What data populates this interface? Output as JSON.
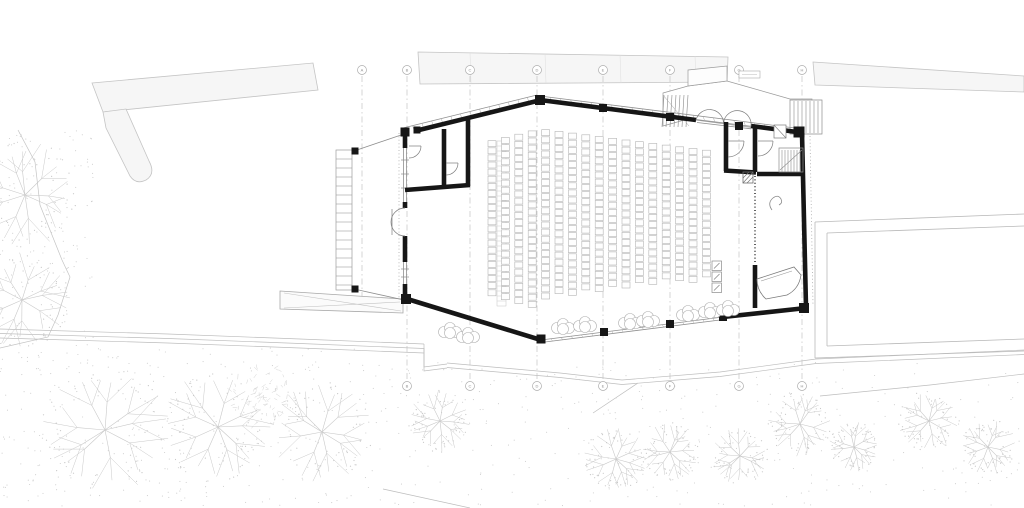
{
  "document": {
    "type": "architectural-floor-plan",
    "description": "Ground floor plan of an auditorium hall with rows of seats, entrance stairs and ramp, side rooms, grand piano room, structural grid axes and surrounding landscape (trees, paths, terrace)."
  },
  "canvas": {
    "width": 1024,
    "height": 508,
    "background": "#ffffff"
  },
  "palette": {
    "wall": "#161616",
    "line": "#6e6e6e",
    "thin": "#8f8f8f",
    "site": "#c4c4c4",
    "site_fill": "#f6f6f6",
    "grid": "#c2c2c2",
    "bubble_stroke": "#adadad",
    "bubble_text": "#8f8f8f",
    "seat": "#b5b5b5",
    "tree": "#c9c9c9",
    "scribble": "#d4d4d4",
    "stipple": "#cccccc",
    "partition": "#4f4f4f",
    "white": "#ffffff"
  },
  "grid": {
    "bubble_r": 4.5,
    "bubble_y_top": 70,
    "bubble_y_bottom": 386,
    "line_y1": 76,
    "line_y2": 380,
    "top_bubbles": [
      {
        "label": "A",
        "x": 362
      },
      {
        "label": "B",
        "x": 407
      },
      {
        "label": "C",
        "x": 470
      },
      {
        "label": "D",
        "x": 537
      },
      {
        "label": "E",
        "x": 603
      },
      {
        "label": "F",
        "x": 670
      },
      {
        "label": "G",
        "x": 739
      },
      {
        "label": "H",
        "x": 802
      }
    ],
    "bottom_bubbles": [
      {
        "label": "B",
        "x": 407
      },
      {
        "label": "C",
        "x": 470
      },
      {
        "label": "D",
        "x": 537
      },
      {
        "label": "E",
        "x": 603
      },
      {
        "label": "F",
        "x": 670
      },
      {
        "label": "G",
        "x": 739
      },
      {
        "label": "H",
        "x": 802
      }
    ],
    "short_line": {
      "x": 362,
      "y1": 76,
      "y2": 302
    }
  },
  "site": {
    "bands": [
      {
        "name": "retaining-wall-top-left",
        "points": "92,83 313,63 318,90 103,112"
      },
      {
        "name": "retaining-wall-top-center",
        "points": "418,52 728,57 727,82 420,84"
      },
      {
        "name": "retaining-wall-top-right",
        "points": "813,62 1024,76 1024,92 815,85"
      }
    ],
    "finger_path": "M103,112 L126,109 L149,161 Q156,174 146,180 Q136,185 130,176 L106,128 Z",
    "band_joints": [
      [
        470,
        53,
        471,
        83
      ],
      [
        545,
        54,
        546,
        83
      ],
      [
        620,
        55,
        621,
        83
      ],
      [
        695,
        56,
        696,
        82
      ]
    ],
    "left_slope_points": "18,130 35,162 40,205 62,260 70,277 58,315 48,337 0,348",
    "terrain_paths": [
      {
        "points": [
          [
            0,
            329
          ],
          [
            168,
            334
          ],
          [
            300,
            339
          ],
          [
            424,
            344
          ]
        ],
        "offsets": [
          0,
          4.5,
          9
        ]
      },
      {
        "points": [
          [
            424,
            344
          ],
          [
            424,
            367
          ],
          [
            447,
            364
          ]
        ],
        "offsets": [
          0,
          4
        ]
      },
      {
        "points": [
          [
            447,
            363
          ],
          [
            560,
            373
          ],
          [
            622,
            380
          ],
          [
            720,
            372
          ],
          [
            816,
            359
          ],
          [
            1024,
            350
          ]
        ],
        "offsets": [
          0,
          4.5
        ]
      },
      {
        "points": [
          [
            820,
            396
          ],
          [
            930,
            385
          ],
          [
            1024,
            374
          ]
        ],
        "offsets": [
          0
        ]
      },
      {
        "points": [
          [
            593,
            413
          ],
          [
            638,
            383
          ]
        ],
        "offsets": [
          0
        ]
      },
      {
        "points": [
          [
            383,
            489
          ],
          [
            470,
            508
          ]
        ],
        "offsets": [
          0
        ]
      }
    ],
    "terrace": {
      "outer": [
        "M815,222 L1024,214",
        "M815,222 L815,358",
        "M815,358 L1024,351"
      ],
      "inner": [
        "M827,233 L1024,226",
        "M827,233 L827,346",
        "M827,346 L1024,339"
      ]
    },
    "walkway": {
      "outline": "280,291 403,299 403,313 280,309",
      "lines": [
        "M284,293 L401,311",
        "M284,308 L400,302"
      ]
    },
    "stipple_regions": [
      {
        "x": 0,
        "y": 348,
        "w": 430,
        "h": 158,
        "count": 380,
        "seed": 11
      },
      {
        "x": 430,
        "y": 362,
        "w": 594,
        "h": 144,
        "count": 300,
        "seed": 29
      },
      {
        "x": 0,
        "y": 128,
        "w": 95,
        "h": 218,
        "count": 130,
        "seed": 47
      }
    ],
    "trees": [
      {
        "x": 25,
        "y": 195,
        "r": 52,
        "style": "branch"
      },
      {
        "x": 22,
        "y": 300,
        "r": 46,
        "style": "branch"
      },
      {
        "x": 105,
        "y": 430,
        "r": 62,
        "style": "branch"
      },
      {
        "x": 218,
        "y": 427,
        "r": 54,
        "style": "branch"
      },
      {
        "x": 262,
        "y": 396,
        "r": 33,
        "style": "scribble"
      },
      {
        "x": 322,
        "y": 432,
        "r": 48,
        "style": "branch"
      },
      {
        "x": 440,
        "y": 421,
        "r": 30,
        "style": "branch"
      },
      {
        "x": 616,
        "y": 459,
        "r": 31,
        "style": "branch"
      },
      {
        "x": 670,
        "y": 452,
        "r": 28,
        "style": "branch"
      },
      {
        "x": 740,
        "y": 456,
        "r": 27,
        "style": "branch"
      },
      {
        "x": 800,
        "y": 424,
        "r": 31,
        "style": "branch"
      },
      {
        "x": 854,
        "y": 447,
        "r": 24,
        "style": "branch"
      },
      {
        "x": 929,
        "y": 421,
        "r": 29,
        "style": "branch"
      },
      {
        "x": 988,
        "y": 447,
        "r": 27,
        "style": "branch"
      },
      {
        "x": 709,
        "y": 91,
        "r": 10,
        "style": "circle"
      }
    ],
    "shrubs": [
      {
        "x": 450,
        "y": 331
      },
      {
        "x": 468,
        "y": 336
      },
      {
        "x": 563,
        "y": 327
      },
      {
        "x": 585,
        "y": 325
      },
      {
        "x": 630,
        "y": 322
      },
      {
        "x": 648,
        "y": 320
      },
      {
        "x": 688,
        "y": 314
      },
      {
        "x": 710,
        "y": 311
      },
      {
        "x": 728,
        "y": 309
      }
    ]
  },
  "building": {
    "walls_thick": [
      "M405,131 L405,148",
      "M405,202 L405,208",
      "M405,236 L405,262",
      "M405,284 L405,300",
      "M415,131 L541,100",
      "M540,100 L696,120",
      "M751,126 L797,132",
      "M802,133 L806,307",
      "M806,308 L723,317",
      "M755,265 L755,308",
      "M404,298 L541,340",
      "M405,190 L470,185",
      "M444,129 L444,189",
      "M468,117 L468,186",
      "M726,122 L726,171",
      "M724,170.5 L756,172.5",
      "M755,128 L755,172",
      "M757,174 L803,174"
    ],
    "blocks": [
      [
        405,
        132,
        9
      ],
      [
        540,
        100,
        10
      ],
      [
        799,
        132,
        11
      ],
      [
        804,
        308,
        10
      ],
      [
        406,
        299,
        10
      ],
      [
        541,
        339,
        9
      ],
      [
        604,
        332,
        8
      ],
      [
        670,
        324,
        8
      ],
      [
        723,
        317,
        8
      ],
      [
        603,
        108,
        8
      ],
      [
        670,
        117,
        8
      ],
      [
        739,
        126,
        8
      ],
      [
        417,
        130,
        7
      ],
      [
        355,
        151,
        7
      ],
      [
        355,
        289,
        7
      ]
    ],
    "thin_paths": [
      "M403,128 L537,95",
      "M540,96 L795,128",
      "M403.5,148 L403.5,204",
      "M406.5,148 L406.5,204",
      "M403.5,262 L403.5,284",
      "M406.5,262 L406.5,284",
      "M696,119.5 L751,126.3",
      "M697,122.5 L751,128.8",
      "M541,340 L723,317",
      "M541,342.5 L724,319.5",
      "M354,151 L404,134",
      "M354,289 L404,300",
      "M392,209 L392,235"
    ],
    "dotted_paths": [
      {
        "d": "M399,133 L399,299",
        "w": 0.8
      },
      {
        "d": "M810,136 L813,306",
        "w": 0.8
      },
      {
        "d": "M755,176 L755,264",
        "w": 1.8,
        "partition": true
      }
    ],
    "window_ticks": [
      [
        401,
        160
      ],
      [
        401,
        174
      ],
      [
        401,
        188
      ],
      [
        401,
        269
      ],
      [
        401,
        277
      ]
    ],
    "door_arcs": [
      "M405,208 A14,14 0 0 0 391,222",
      "M405,236 A14,14 0 0 1 391,222",
      "M421,146 A12,12 0 0 1 409,158",
      "M409,146 L421,146",
      "M458,163 A12,12 0 0 1 446,175",
      "M446,163 L458,163",
      "M744,141 A16,16 0 0 1 728,157",
      "M728,141 L744,141",
      "M773,141 A15,15 0 0 1 758,156",
      "M758,141 L773,141",
      "M696,120 A14,14 0 0 1 723.5,122.5",
      "M751,126.5 A13.5,13.5 0 0 0 723.5,122.5"
    ],
    "hatch_bands": [
      {
        "from": [
          403,
          128
        ],
        "to": [
          537,
          95
        ],
        "drop": 5,
        "n": 14
      },
      {
        "from": [
          540,
          96
        ],
        "to": [
          795,
          128
        ],
        "drop": 4.5,
        "n": 25
      },
      {
        "from": [
          541,
          340
        ],
        "to": [
          723,
          317
        ],
        "drop": 2.5,
        "n": 18
      }
    ],
    "interior": {
      "stair_room": {
        "rect": "M779,148 L803,148 L803,172 L779,172 Z",
        "treads_x": [
          782,
          785,
          788,
          791,
          794,
          797,
          800
        ],
        "treads_y": [
          150,
          172
        ],
        "arrow": "M780,170 L802,150"
      },
      "hatch_square": {
        "rect": [
          743,
          172,
          10,
          11
        ],
        "hatch": [
          "M743,183 L753,172",
          "M743,178 L749,172",
          "M747,183 L753,177"
        ]
      },
      "fixture": {
        "rect": [
          774,
          125,
          12,
          13
        ],
        "diag": "M774,125 L786,138"
      },
      "note_symbol": "M772,210 q-5,-7 1,-12 q5,-4 8,1 q2,4 -2,6",
      "piano": {
        "body": "M757,279 L794,267 L801,275 Q799,289 787,295 L766,299 Q757,291 757,279 Z",
        "inner": "M761,281 L792,271"
      },
      "ladder_strip": {
        "x": 497,
        "w": 9,
        "y1": 141,
        "y2": 306,
        "step": 5
      }
    },
    "annex": {
      "ramp_ladder": {
        "x": 336,
        "w": 16,
        "y1": 150,
        "y2": 290,
        "step": 9
      }
    },
    "landing": {
      "outline": "M663,93 L688,86 L727,81 L790,99 L812,99 L812,133 L793,133 L688,119 L663,126 Z",
      "upper_rect": "M688,70 L727,66 L727,81 L688,86 Z",
      "label_box": {
        "rect": [
          739,
          71,
          21,
          7
        ],
        "line": "M742,74.5 L757,74.5"
      },
      "stair_a": {
        "x1": 664,
        "x2": 688,
        "step": 4,
        "y1": 95,
        "y2": 127,
        "diag": "M663,95 L689,126"
      },
      "stair_b": {
        "rect": "M790,100 L822,100 L822,134 L790,134 Z",
        "x1": 794,
        "x2": 818,
        "step": 4,
        "y1": 101,
        "y2": 133
      }
    }
  },
  "seating": {
    "columns": 17,
    "x_start": 492,
    "x_step": 13.4,
    "seat_width": 8,
    "seat_height": 6,
    "seat_gap": 1.1,
    "apex_x": 540,
    "top_wall": {
      "x_left": 405,
      "y_left": 133,
      "y_apex": 100,
      "x_right": 795,
      "y_right": 132.5
    },
    "bottom_wall": {
      "x_left": 405,
      "y_left": 299,
      "x_mid": 540,
      "y_mid": 340,
      "x_right": 737,
      "y_right": 316
    },
    "top_clearance": 29,
    "bottom_clearance_left": 28,
    "bottom_clearance_right": 39,
    "accessible_seats": {
      "count": 3,
      "x": 712,
      "y_start": 261,
      "size": 9.5,
      "gap": 1.5
    }
  }
}
